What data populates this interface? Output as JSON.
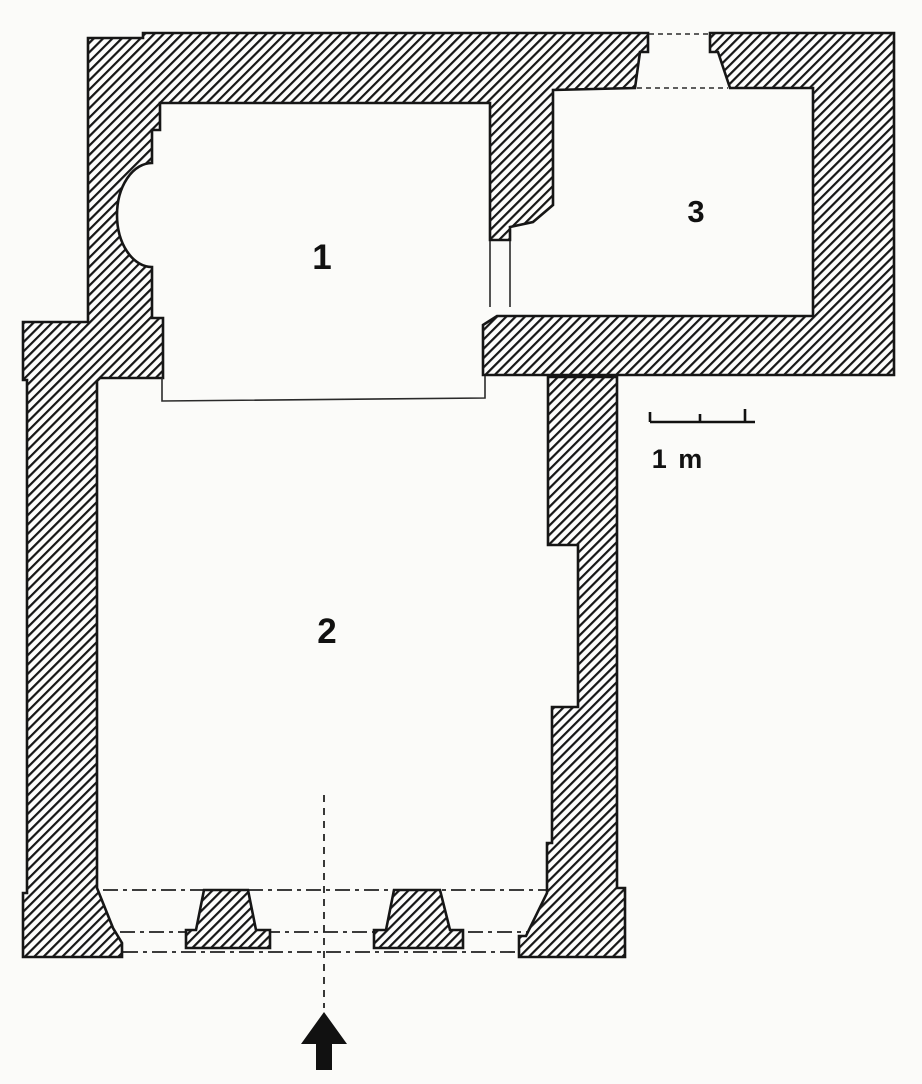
{
  "figure": {
    "kind": "architectural-floor-plan",
    "rooms": [
      {
        "id": 1,
        "label": "1"
      },
      {
        "id": 2,
        "label": "2"
      },
      {
        "id": 3,
        "label": "3"
      }
    ],
    "scale_bar": {
      "label": "1 m",
      "length_meters": 1
    },
    "entrance": {
      "arrow_direction": "up"
    },
    "colors": {
      "ink": "#161616",
      "paper": "#fbfbf9",
      "room_interior": "#fdfdfc"
    }
  }
}
